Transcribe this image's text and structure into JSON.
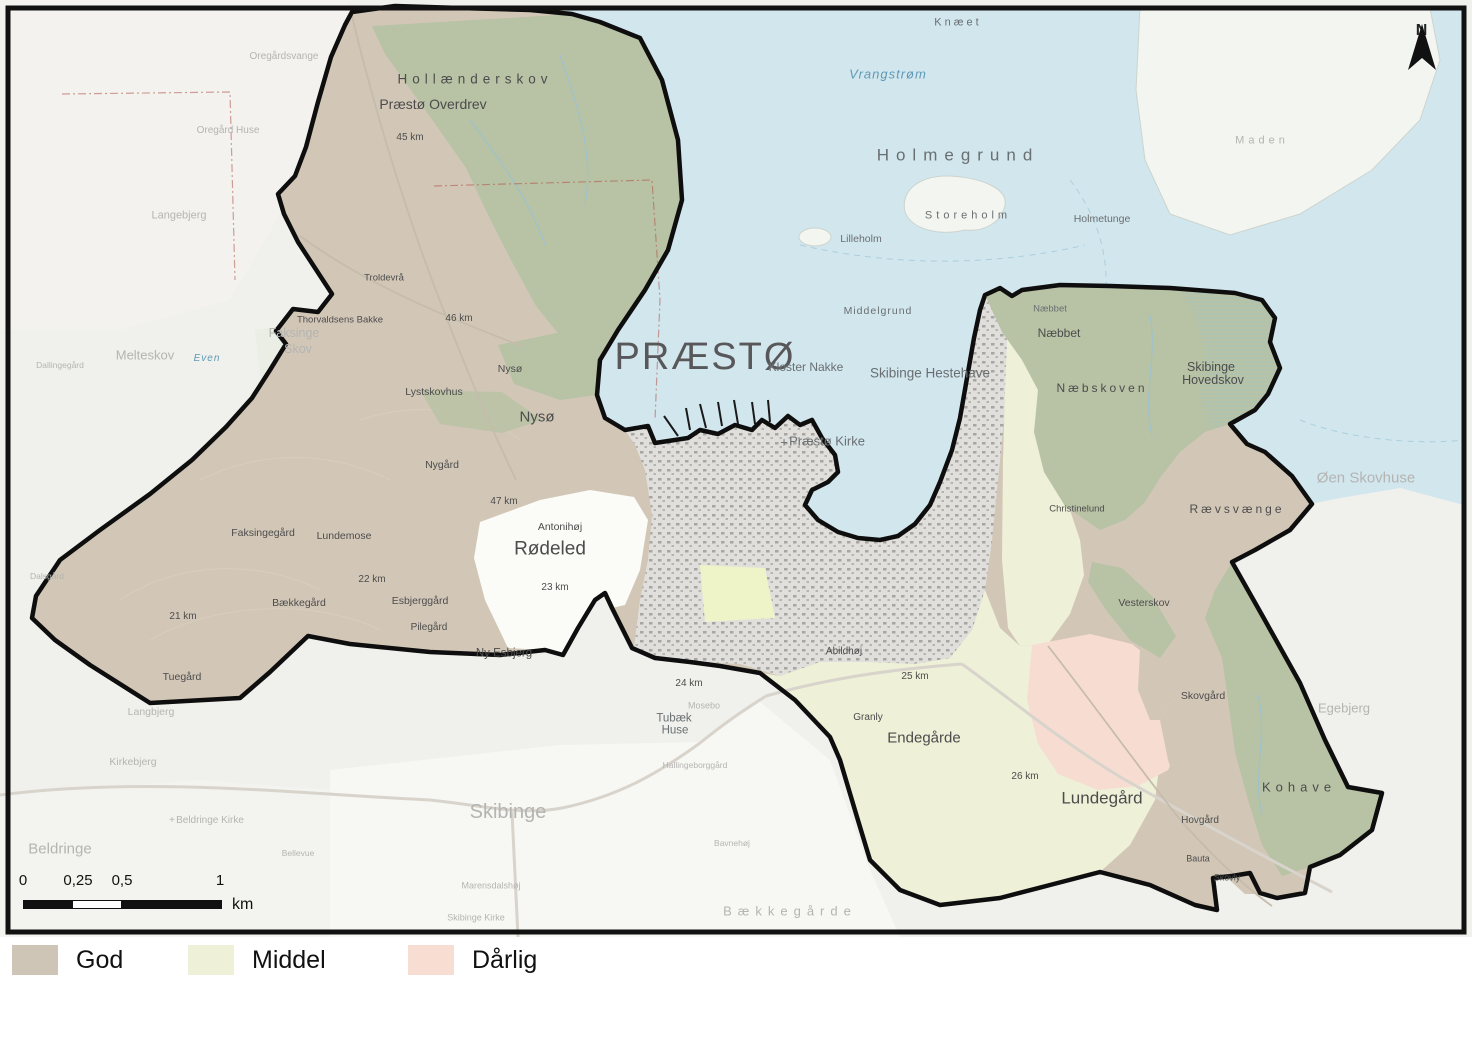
{
  "north_label": "N",
  "scalebar": {
    "ticks": [
      {
        "text": "0",
        "x": 23
      },
      {
        "text": "0,25",
        "x": 78
      },
      {
        "text": "0,5",
        "x": 122
      },
      {
        "text": "1",
        "x": 220
      }
    ],
    "unit": "km"
  },
  "legend": {
    "items": [
      {
        "label": "God",
        "color": "#cfc5b6"
      },
      {
        "label": "Middel",
        "color": "#eef0d8"
      },
      {
        "label": "Dårlig",
        "color": "#f8ddd3"
      }
    ]
  },
  "label_colors": {
    "dark": "#4c4c4c",
    "mid": "#6a6f71",
    "faint": "#b4b4b2",
    "blue": "#5e9ab4",
    "big": "#58585a"
  },
  "map_labels": [
    [
      "Knæet",
      958,
      23,
      11,
      "mid",
      3
    ],
    [
      "Vrangstrøm",
      888,
      74,
      13,
      "blue",
      1,
      true
    ],
    [
      "Holmegrund",
      958,
      155,
      17,
      "mid",
      7
    ],
    [
      "Storeholm",
      968,
      216,
      11,
      "mid",
      4
    ],
    [
      "Lilleholm",
      861,
      239,
      10.5,
      "mid",
      0
    ],
    [
      "Holmetunge",
      1102,
      219,
      10.5,
      "mid",
      0
    ],
    [
      "Maden",
      1262,
      141,
      11,
      "faint",
      4
    ],
    [
      "Middelgrund",
      878,
      311,
      10.5,
      "mid",
      1
    ],
    [
      "PRÆSTØ",
      705,
      357,
      38,
      "big",
      2
    ],
    [
      "Kloster Nakke",
      806,
      367,
      12,
      "mid",
      0
    ],
    [
      "Skibinge Hestehave",
      930,
      373,
      13.5,
      "mid",
      0
    ],
    [
      "Præstø Kirke",
      827,
      441,
      13,
      "mid",
      0
    ],
    [
      "+",
      784,
      442,
      13,
      "mid",
      0
    ],
    [
      "Næbbet",
      1050,
      309,
      9.5,
      "mid",
      0
    ],
    [
      "Næbbet",
      1059,
      333,
      12,
      "dark",
      0
    ],
    [
      "Næbskoven",
      1102,
      388,
      12,
      "dark",
      3
    ],
    [
      "Skibinge",
      1211,
      367,
      12.5,
      "dark",
      0
    ],
    [
      "Hovedskov",
      1213,
      380,
      12.5,
      "dark",
      0
    ],
    [
      "Rævsvænge",
      1237,
      509,
      12,
      "dark",
      3
    ],
    [
      "Øen Skovhuse",
      1366,
      478,
      15,
      "faint",
      0
    ],
    [
      "Christinelund",
      1077,
      509,
      9.5,
      "dark",
      0
    ],
    [
      "Vesterskov",
      1144,
      603,
      10.5,
      "dark",
      0
    ],
    [
      "Skovgård",
      1203,
      696,
      10.5,
      "dark",
      0
    ],
    [
      "Egebjerg",
      1344,
      708,
      13,
      "faint",
      0
    ],
    [
      "Kohave",
      1299,
      787,
      13,
      "dark",
      5
    ],
    [
      "Lundegård",
      1102,
      798,
      17,
      "dark",
      0
    ],
    [
      "Hovgård",
      1200,
      821,
      10,
      "dark",
      0
    ],
    [
      "Bauta",
      1198,
      859,
      9,
      "dark",
      0
    ],
    [
      "Skovly",
      1227,
      878,
      9,
      "dark",
      0
    ],
    [
      "26 km",
      1025,
      777,
      10,
      "dark",
      0
    ],
    [
      "25 km",
      915,
      677,
      10,
      "dark",
      0
    ],
    [
      "Granly",
      868,
      718,
      10,
      "dark",
      0
    ],
    [
      "Endegårde",
      924,
      738,
      15,
      "dark",
      0
    ],
    [
      "Abildhøj",
      844,
      652,
      10,
      "dark",
      0
    ],
    [
      "24 km",
      689,
      684,
      10,
      "dark",
      0
    ],
    [
      "Tubæk",
      674,
      719,
      11.5,
      "mid",
      0
    ],
    [
      "Huse",
      675,
      731,
      11.5,
      "mid",
      0
    ],
    [
      "Mosebo",
      704,
      706,
      9,
      "faint",
      0
    ],
    [
      "Skibinge",
      508,
      812,
      20,
      "faint",
      0
    ],
    [
      "Marensdalshøj",
      491,
      886,
      9,
      "faint",
      0
    ],
    [
      "Skibinge Kirke",
      476,
      918,
      9,
      "faint",
      0
    ],
    [
      "Bavnehøj",
      732,
      843,
      8.5,
      "faint",
      0
    ],
    [
      "Bækkegårde",
      790,
      911,
      13,
      "faint",
      6
    ],
    [
      "Hallingeborggård",
      695,
      765,
      8.5,
      "faint",
      0
    ],
    [
      "Langbjerg",
      151,
      712,
      10.5,
      "faint",
      0
    ],
    [
      "Kirkebjerg",
      133,
      762,
      10.5,
      "faint",
      0
    ],
    [
      "Beldringe Kirke",
      210,
      821,
      10,
      "faint",
      0
    ],
    [
      "+",
      172,
      821,
      10,
      "faint",
      0
    ],
    [
      "Beldringe",
      60,
      849,
      15,
      "faint",
      0
    ],
    [
      "Bellevue",
      298,
      853,
      8.5,
      "faint",
      0
    ],
    [
      "Langebjerg",
      179,
      216,
      11,
      "faint",
      0
    ],
    [
      "Melteskov",
      145,
      355,
      13,
      "faint",
      0
    ],
    [
      "Even",
      207,
      359,
      10,
      "blue",
      1,
      true
    ],
    [
      "Dallingegård",
      60,
      365,
      8.5,
      "faint",
      0
    ],
    [
      "Faksinge",
      294,
      333,
      12.5,
      "faint",
      0
    ],
    [
      "Skov",
      298,
      349,
      12.5,
      "faint",
      0
    ],
    [
      "Oregårdsvange",
      284,
      57,
      10,
      "faint",
      0
    ],
    [
      "Oregård Huse",
      228,
      131,
      10,
      "faint",
      0
    ],
    [
      "Dalsgård",
      47,
      576,
      8.5,
      "faint",
      0
    ],
    [
      "Hollænderskov",
      475,
      79,
      13.5,
      "dark",
      5
    ],
    [
      "Præstø Overdrev",
      433,
      104,
      14,
      "dark",
      0
    ],
    [
      "45 km",
      410,
      138,
      10,
      "dark",
      0
    ],
    [
      "Troldevrå",
      384,
      278,
      9.5,
      "dark",
      0
    ],
    [
      "Thorvaldsens Bakke",
      340,
      320,
      9.5,
      "dark",
      0
    ],
    [
      "46 km",
      459,
      319,
      10,
      "dark",
      0
    ],
    [
      "Nysø",
      510,
      369,
      10.5,
      "dark",
      0
    ],
    [
      "Nysø",
      537,
      417,
      15,
      "dark",
      0
    ],
    [
      "Lystskovhus",
      434,
      392,
      10.5,
      "dark",
      0
    ],
    [
      "Nygård",
      442,
      465,
      10.5,
      "dark",
      0
    ],
    [
      "47 km",
      504,
      502,
      10,
      "dark",
      0
    ],
    [
      "Antonihøj",
      560,
      527,
      10.5,
      "dark",
      0
    ],
    [
      "Rødeled",
      550,
      549,
      19,
      "dark",
      0
    ],
    [
      "23 km",
      555,
      588,
      10,
      "dark",
      0
    ],
    [
      "Faksingegård",
      263,
      533,
      10.5,
      "dark",
      0
    ],
    [
      "Lundemose",
      344,
      536,
      10.5,
      "dark",
      0
    ],
    [
      "22 km",
      372,
      580,
      10,
      "dark",
      0
    ],
    [
      "Bækkegård",
      299,
      603,
      10.5,
      "dark",
      0
    ],
    [
      "Esbjerggård",
      420,
      601,
      10.5,
      "dark",
      0
    ],
    [
      "Pilegård",
      429,
      628,
      10,
      "dark",
      0
    ],
    [
      "21 km",
      183,
      617,
      10,
      "dark",
      0
    ],
    [
      "Tuegård",
      182,
      677,
      10.5,
      "dark",
      0
    ],
    [
      "Ny Esbjerg",
      504,
      654,
      11.5,
      "dark",
      0
    ]
  ]
}
